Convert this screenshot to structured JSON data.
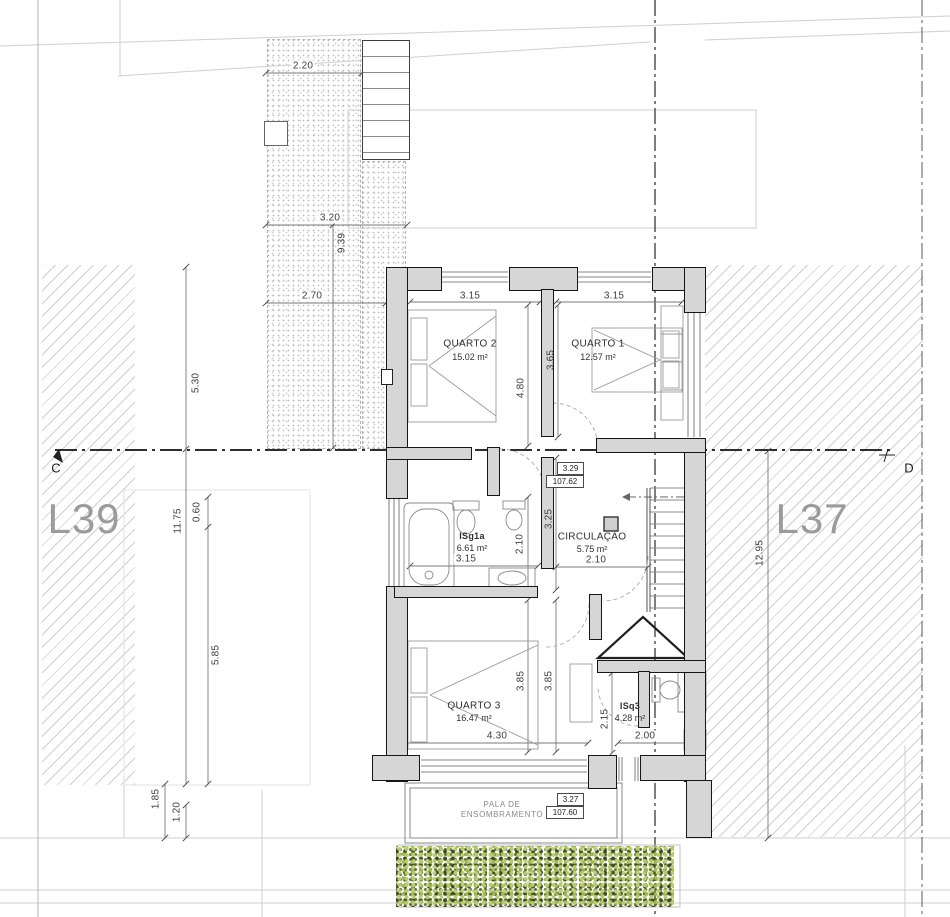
{
  "plot": {
    "left_label": "L39",
    "right_label": "L37",
    "section_start": "C",
    "section_end": "D"
  },
  "rooms": {
    "quarto2": {
      "name": "QUARTO 2",
      "area": "15.02 m²"
    },
    "quarto1": {
      "name": "QUARTO 1",
      "area": "12.57 m²"
    },
    "isg1a": {
      "name": "ISg1a",
      "area": "6.61 m²"
    },
    "circulacao": {
      "name": "CIRCULAÇÃO",
      "area": "5.75 m²"
    },
    "quarto3": {
      "name": "QUARTO 3",
      "area": "16.47 m²"
    },
    "isq3": {
      "name": "ISq3",
      "area": "4.28 m²"
    },
    "pala": {
      "line1": "PALA DE",
      "line2": "ENSOMBRAMENTO"
    }
  },
  "levels": {
    "upper": {
      "relative": "3.29",
      "absolute": "107.62"
    },
    "lower": {
      "relative": "3.27",
      "absolute": "107.60"
    }
  },
  "dimensions": {
    "site": {
      "d220": "2.20",
      "d320": "3.20",
      "d939": "9.39",
      "d270": "2.70",
      "d530": "5.30",
      "d1175": "11.75",
      "d060": "0.60",
      "d585": "5.85",
      "d185": "1.85",
      "d120": "1.20",
      "d1295": "12.95"
    },
    "interior": {
      "q2_w": "3.15",
      "q1_w": "3.15",
      "q2_h": "4.80",
      "q1_h": "3.65",
      "hall_h": "3.25",
      "bath_h": "2.10",
      "bath_w": "3.15",
      "circ_w": "2.10",
      "q3_h1": "3.85",
      "q3_h2": "3.85",
      "q3_w": "4.30",
      "isq3_h": "2.15",
      "isq3_w": "2.00"
    }
  },
  "colors": {
    "wall_fill": "#d6d6d6",
    "wall_line": "#161616",
    "dim_text": "#3d3d3d",
    "plot_label": "#9b9b9b",
    "hedge_light": "#b9cc6e",
    "hedge_dark": "#3e4a1f"
  }
}
